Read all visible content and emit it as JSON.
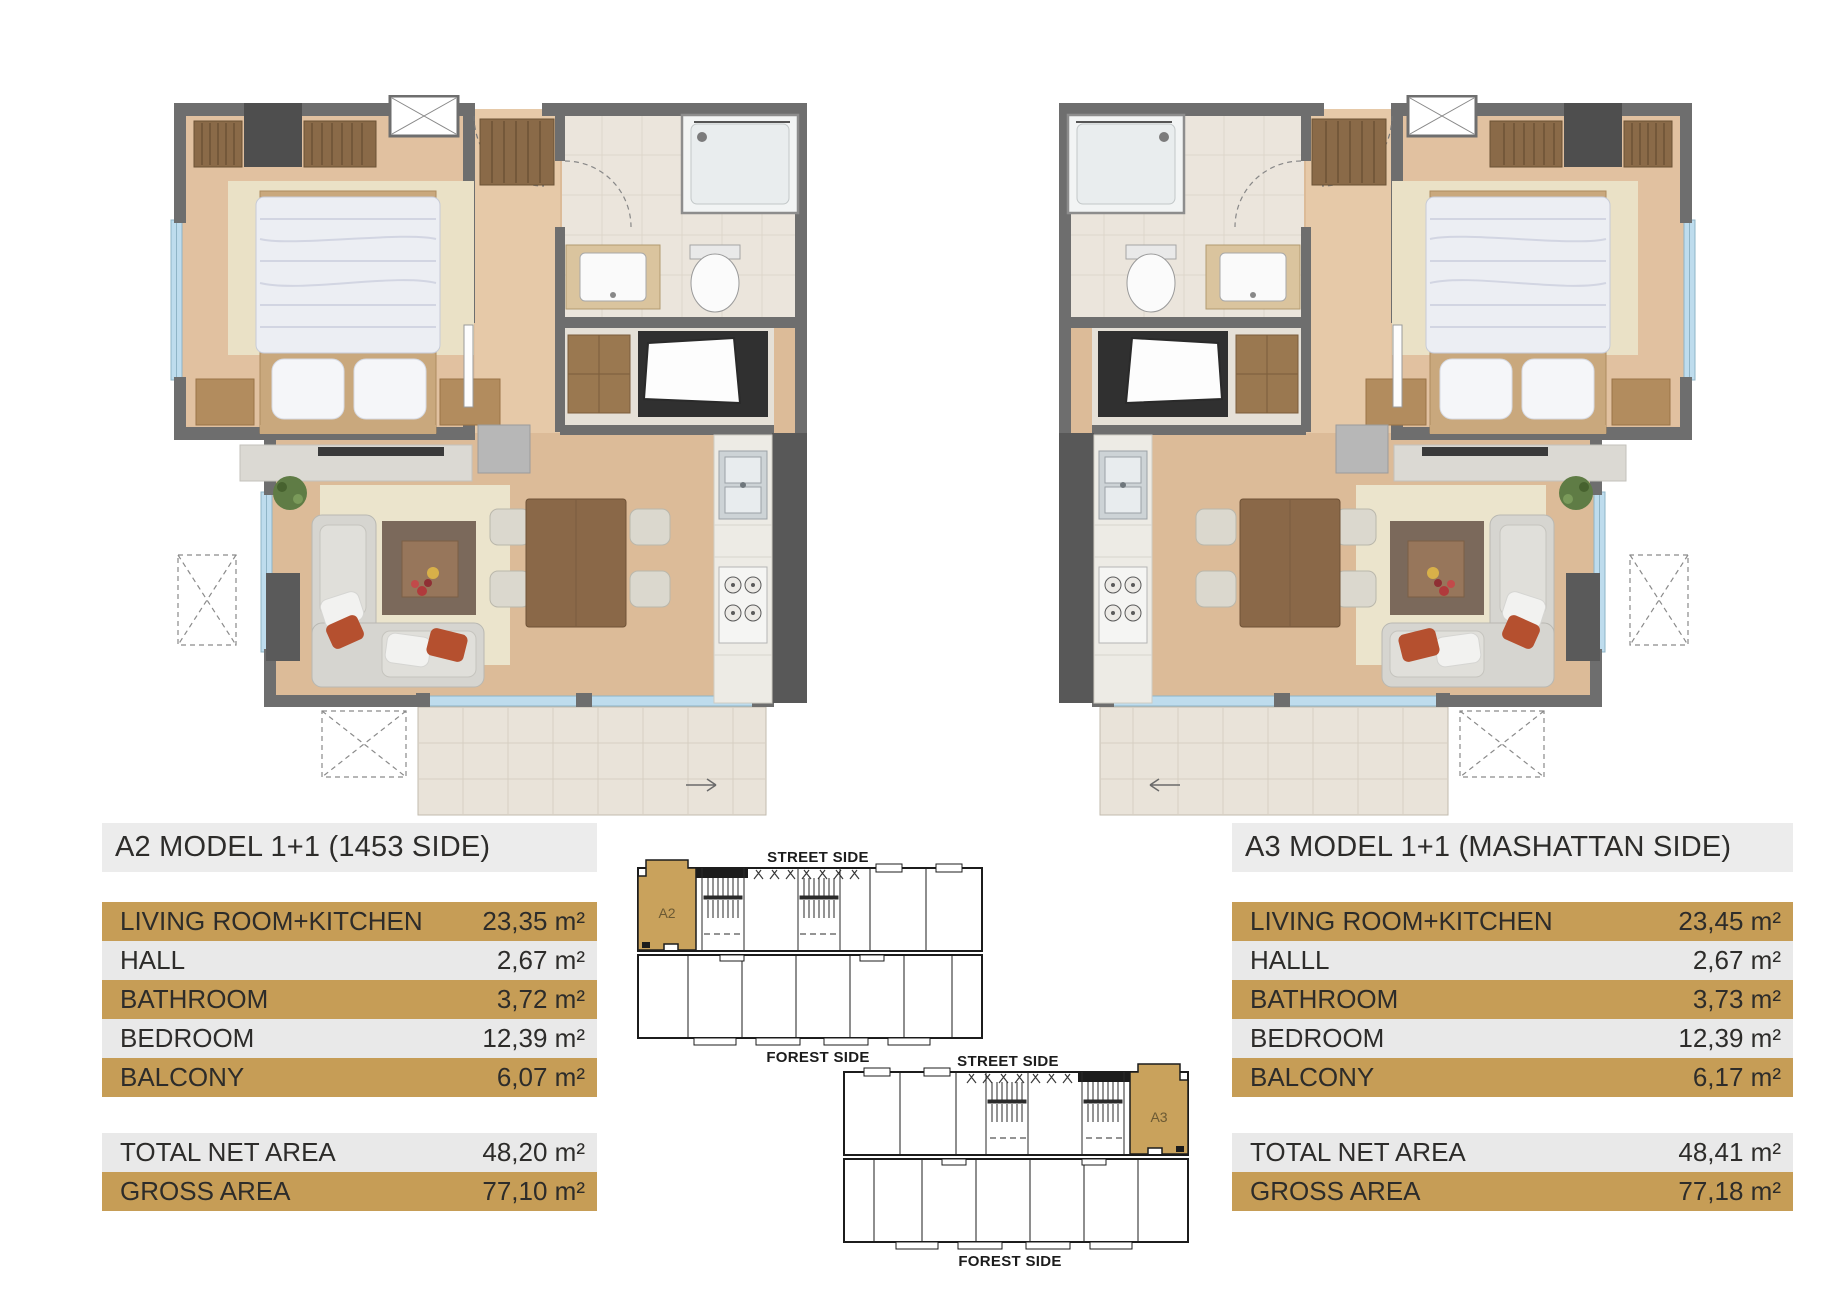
{
  "document": {
    "background": "#ffffff"
  },
  "colors": {
    "accent_gold": "#c69d56",
    "row_gray": "#e9e9e9",
    "title_gray": "#ececec",
    "text": "#2d2c2a",
    "keyplan_gold": "#c9a25c",
    "wall_gray": "#6e6e6e",
    "wood_floor": "#dfbf9e",
    "window_blue": "#bedced"
  },
  "units": [
    {
      "id": "A2",
      "title": "A2 MODEL 1+1 (1453 SIDE)",
      "rows": [
        {
          "label": "LIVING ROOM+KITCHEN",
          "value": "23,35 m²"
        },
        {
          "label": "HALL",
          "value": "2,67 m²"
        },
        {
          "label": "BATHROOM",
          "value": "3,72 m²"
        },
        {
          "label": "BEDROOM",
          "value": "12,39 m²"
        },
        {
          "label": "BALCONY",
          "value": "6,07 m²"
        }
      ],
      "totals": [
        {
          "label": "TOTAL NET AREA",
          "value": "48,20 m²"
        },
        {
          "label": "GROSS AREA",
          "value": "77,10 m²"
        }
      ]
    },
    {
      "id": "A3",
      "title": "A3 MODEL 1+1 (MASHATTAN SIDE)",
      "rows": [
        {
          "label": "LIVING ROOM+KITCHEN",
          "value": "23,45 m²"
        },
        {
          "label": "HALLL",
          "value": "2,67 m²"
        },
        {
          "label": "BATHROOM",
          "value": "3,73 m²"
        },
        {
          "label": "BEDROOM",
          "value": "12,39 m²"
        },
        {
          "label": "BALCONY",
          "value": "6,17 m²"
        }
      ],
      "totals": [
        {
          "label": "TOTAL NET AREA",
          "value": "48,41 m²"
        },
        {
          "label": "GROSS AREA",
          "value": "77,18 m²"
        }
      ]
    }
  ],
  "keyplans": [
    {
      "unit": "A2",
      "street_label": "STREET SIDE",
      "forest_label": "FOREST SIDE"
    },
    {
      "unit": "A3",
      "street_label": "STREET SIDE",
      "forest_label": "FOREST SIDE"
    }
  ]
}
